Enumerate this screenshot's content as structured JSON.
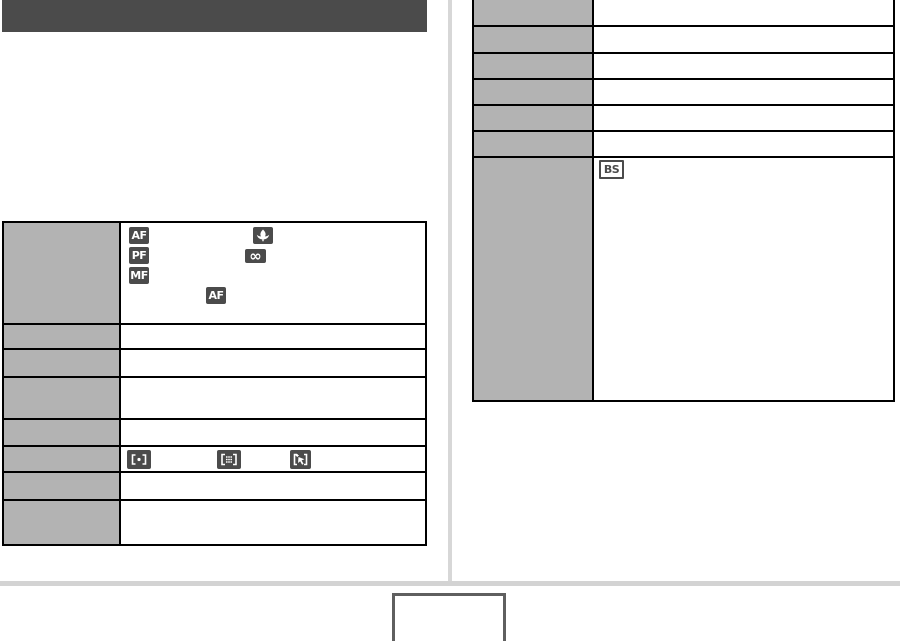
{
  "colors": {
    "title_bar": "#4b4b4b",
    "table_label_bg": "#b3b3b3",
    "table_border": "#000000",
    "icon_dark_bg": "#4b4b4b",
    "icon_glyph": "#ffffff",
    "column_divider": "#d7d7d7",
    "footer_rule": "#d3d3d3",
    "page_number_box_border": "#5f5f5f"
  },
  "title_bar": {
    "text": ""
  },
  "icons": {
    "af_label": "AF",
    "pf_label": "PF",
    "mf_label": "MF",
    "infinity_label": "∞",
    "bs_label": "BS"
  },
  "left_table": {
    "rows": [
      {
        "label": "",
        "icons": [
          "autofocus",
          "macro-flower",
          "pan-focus",
          "infinity",
          "manual-focus",
          "autofocus"
        ]
      },
      {
        "label": "",
        "icons": []
      },
      {
        "label": "",
        "icons": []
      },
      {
        "label": "",
        "icons": []
      },
      {
        "label": "",
        "icons": []
      },
      {
        "label": "",
        "icons": [
          "spot-af-area",
          "multi-af-area",
          "tracking-af-area"
        ]
      },
      {
        "label": "",
        "icons": []
      },
      {
        "label": "",
        "icons": []
      }
    ]
  },
  "right_table": {
    "rows": [
      {
        "label": "",
        "icons": []
      },
      {
        "label": "",
        "icons": []
      },
      {
        "label": "",
        "icons": []
      },
      {
        "label": "",
        "icons": []
      },
      {
        "label": "",
        "icons": []
      },
      {
        "label": "",
        "icons": []
      },
      {
        "label": "",
        "icons": [
          "best-shot"
        ]
      }
    ]
  },
  "footer": {
    "page_number": ""
  }
}
